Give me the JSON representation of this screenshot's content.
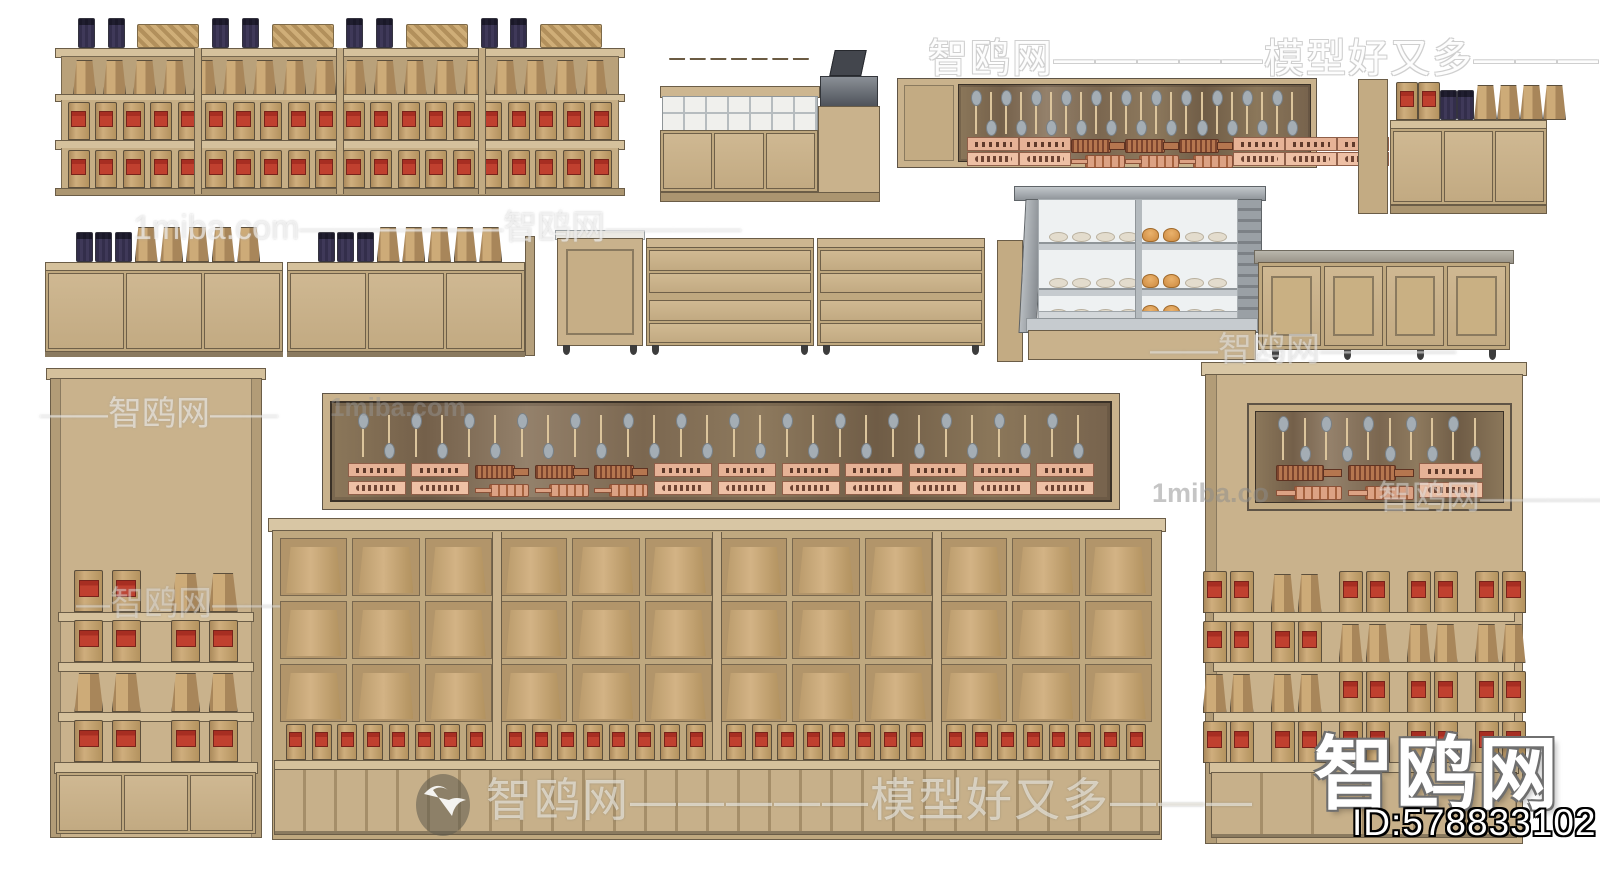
{
  "watermarks": {
    "top_banner": "智鸥网—————模型好又多———",
    "upper_band": "1miba.com——————智鸥网————",
    "panel_brand": "1miba.com",
    "left_band_1": "——智鸥网——",
    "left_band_2": "—智鸥网——",
    "right_band_1": "——智鸥网————",
    "right_brand": "1miba.co",
    "right_band_2": "智鸥网————",
    "bottom_banner": "智鸥网—————模型好又多———",
    "corner_logo": "智鸥网",
    "model_id": "ID:578833102"
  },
  "colors": {
    "background": "#ffffff",
    "cabinet_wood": "#c9b28c",
    "cabinet_shadow": "#b29c77",
    "shelf_board": "#d5c19c",
    "dark_panel_wood": "#8b775a",
    "kraft_bag": "#cdab78",
    "red_label": "#b23327",
    "purple_jar": "#7b7592",
    "metal_gray": "#9aa0a5",
    "glass": "#eef1f2",
    "bun_orange": "#d08a3f",
    "spoon_head": "#a4adb4",
    "copper_tool": "#e6b296"
  },
  "scene": {
    "unit_a": {
      "top_items": "jjbjjbjjbjjb",
      "kraft_bags": "kkkkkkkkkkkkkkkkkk",
      "red_bags_row1": "rrrrrrrrrrrrrrrrrrrr",
      "red_bags_row2": "rrrrrrrrrrrrrrrrrrrr"
    },
    "unit_b": {
      "cups": "ccccccc",
      "doors": 3
    },
    "unit_c": {
      "spoons": "ududududududududududud",
      "tools_row1": "pphhhppp",
      "tools_row2": "qqvvvqqq"
    },
    "unit_d": {
      "top_items": "rrjjkkkk",
      "doors": 3
    },
    "unit_e": {
      "section1_items": "jjjkkkkk",
      "section2_items": "jjjkkkkk",
      "section1_doors": 3,
      "section2_doors": 3
    },
    "unit_f": {
      "drawers_left": 4,
      "drawers_right": 4
    },
    "unit_g": {
      "shelf1_buns": "oooonnoo",
      "shelf2_buns": "oooonnoo",
      "shelf3_buns": "oooonnoo"
    },
    "unit_h": {
      "doors": 4
    },
    "unit_i": {
      "shelf1": "rrskk",
      "shelf2": "rrsrr",
      "shelf3": "kkskk",
      "shelf4": "rrsrr",
      "doors": 3
    },
    "unit_j": {
      "spoons": "udududududududududududududud",
      "tools_row1": "pphhhppppppp",
      "tools_row2": "qqvvvqqqqqqq"
    },
    "unit_k": {
      "compartments_per_bay": 9,
      "ledge_bags": "rrrrrrrr"
    },
    "unit_l": {
      "panel_spoons": "ududududud",
      "panel_tools_row1": "hhp",
      "panel_tools_row2": "vvq",
      "shelf1": "rrskksrrsrrsrr",
      "shelf2": "rrsrrskkskkskk",
      "shelf3": "kkskksrrsrrsrr",
      "shelf4": "rrsrrsrrsrrsrr"
    }
  }
}
